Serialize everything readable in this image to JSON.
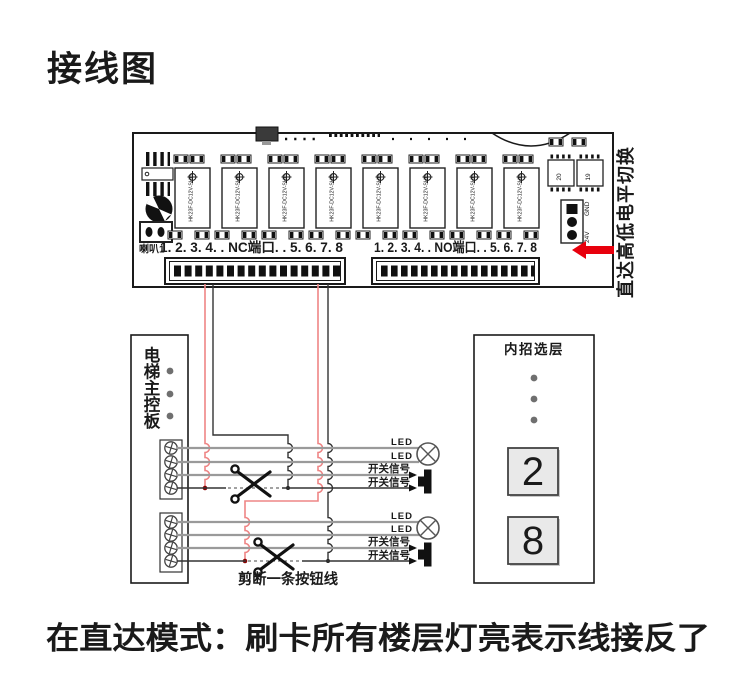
{
  "page": {
    "title": "接线图",
    "footer": "在直达模式：刷卡所有楼层灯亮表示线接反了"
  },
  "board": {
    "nc_port_label": "1. 2. 3. 4. . NC端口. . 5. 6. 7. 8",
    "no_port_label": "1. 2. 3. 4. . NO端口. . 5. 6. 7. 8",
    "speaker_label": "喇叭1",
    "relay_model": "HK23F-DC12V-SHG",
    "chip_left_label": "20",
    "chip_right_label": "19",
    "jumper_gnd_label": "GND",
    "jumper_24v_label": "24V",
    "level_switch_note": "直达高低电平切换"
  },
  "controller_box": {
    "title": "电梯主控板",
    "title_chars": [
      "电",
      "梯",
      "主",
      "控",
      "板"
    ]
  },
  "wiring": {
    "led_label": "LED",
    "switch_label": "开关信号",
    "cut_note": "剪断一条按钮线"
  },
  "panel": {
    "title": "内招选层",
    "buttons": [
      "2",
      "8"
    ]
  },
  "colors": {
    "accent_red": "#E8000D",
    "wire_red": "#EE8585",
    "title_brown": "#A8814C",
    "footer_brown": "#AF8146"
  }
}
